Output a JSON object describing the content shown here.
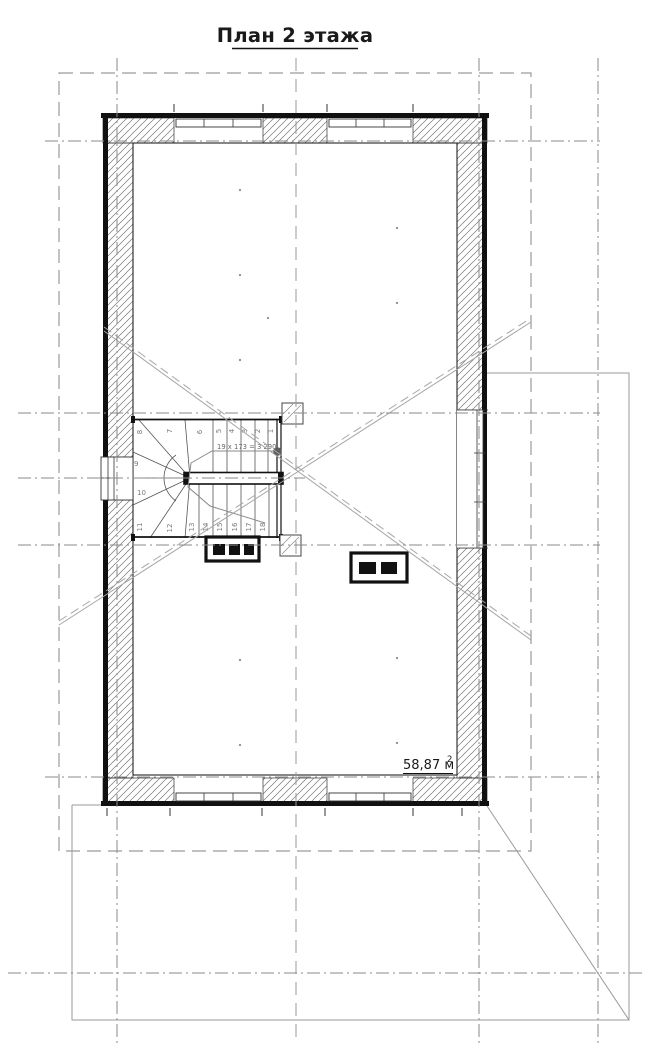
{
  "title": {
    "text": "План 2 этажа"
  },
  "floor_plan": {
    "stairs": {
      "dimension_label": "19 x 173 = 3 290",
      "steps": [
        "1",
        "2",
        "3",
        "4",
        "5",
        "6",
        "7",
        "8",
        "9",
        "10",
        "11",
        "12",
        "13",
        "14",
        "15",
        "16",
        "17",
        "18"
      ]
    },
    "area_label": {
      "value_unit": "58,87 м",
      "superscript": "2"
    },
    "colors": {
      "wall_line": "#111111",
      "axis_gray": "#8a8a8a",
      "roof_outline_gray": "#9a9a9a",
      "hatch_gray": "#777777"
    }
  }
}
